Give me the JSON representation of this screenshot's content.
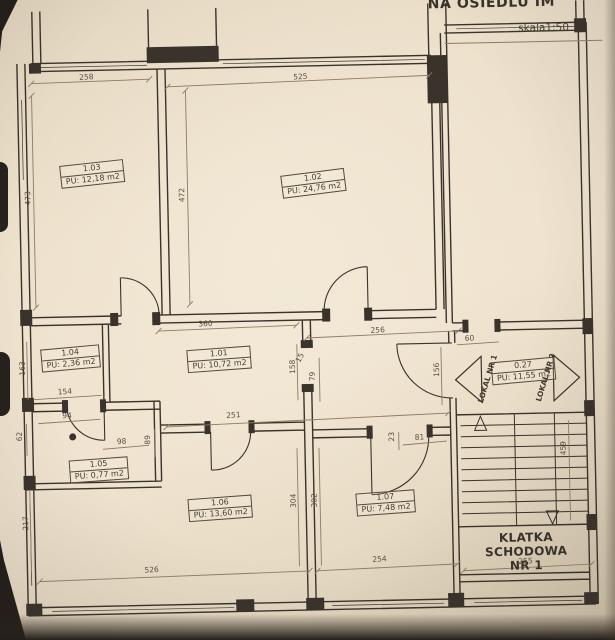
{
  "header": {
    "title_fragment": "NA OSIEDLU IM",
    "scale": "skala1:50"
  },
  "rooms": [
    {
      "id": "1.03",
      "area": "PU: 12,18 m2"
    },
    {
      "id": "1.02",
      "area": "PU: 24,76 m2"
    },
    {
      "id": "1.01",
      "area": "PU: 10,72 m2"
    },
    {
      "id": "1.04",
      "area": "PU: 2,36 m2"
    },
    {
      "id": "1.05",
      "area": "PU: 0,77 m2"
    },
    {
      "id": "1.06",
      "area": "PU: 13,60 m2"
    },
    {
      "id": "1.07",
      "area": "PU: 7,48 m2"
    },
    {
      "id": "0.27",
      "area": "PU: 11,55 m2"
    }
  ],
  "stairwell": {
    "name_line1": "KLATKA SCHODOWA",
    "name_line2": "NR 1"
  },
  "units": {
    "lokal1": "LOKAL NR 1",
    "lokal2": "LOKAL NR 2"
  },
  "icons": {
    "lokal1_arrow": "left-arrow",
    "lokal2_arrow": "right-arrow",
    "stairs_up_arrow": "up-triangle",
    "stairs_down_arrow": "down-triangle"
  },
  "colors": {
    "paper": "#ece0cb",
    "ink": "#3a332b",
    "dim_line": "#8c7b66"
  },
  "dims": [
    {
      "v": "258"
    },
    {
      "v": "525"
    },
    {
      "v": "473"
    },
    {
      "v": "472"
    },
    {
      "v": "360"
    },
    {
      "v": "256"
    },
    {
      "v": "60"
    },
    {
      "v": "163"
    },
    {
      "v": "154"
    },
    {
      "v": "94"
    },
    {
      "v": "62"
    },
    {
      "v": "98"
    },
    {
      "v": "89"
    },
    {
      "v": "251"
    },
    {
      "v": "158"
    },
    {
      "v": "79"
    },
    {
      "v": "156"
    },
    {
      "v": "23"
    },
    {
      "v": "81"
    },
    {
      "v": "304"
    },
    {
      "v": "302"
    },
    {
      "v": "217"
    },
    {
      "v": "459"
    },
    {
      "v": "526"
    },
    {
      "v": "254"
    },
    {
      "v": "255"
    },
    {
      "v": "15"
    }
  ]
}
